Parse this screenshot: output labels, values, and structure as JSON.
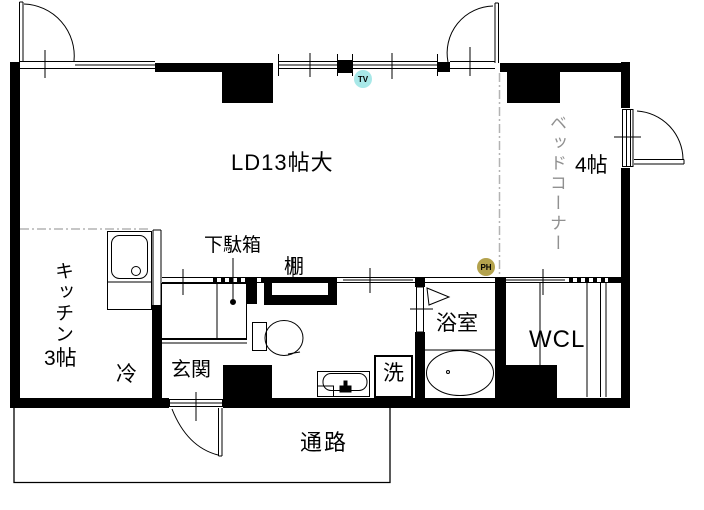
{
  "labels": {
    "living_dining": "LD13帖大",
    "bed_corner": "ベッドコーナー",
    "bed_corner_size": "4帖",
    "kitchen": "キッチン",
    "kitchen_size": "3帖",
    "refrigerator": "冷",
    "entrance": "玄関",
    "shoe_cabinet": "下駄箱",
    "shelf": "棚",
    "bathroom": "浴室",
    "washing_machine": "洗",
    "walk_in_closet": "WCL",
    "passage": "通路"
  },
  "markers": {
    "tv": {
      "label": "TV",
      "bg": "#a8e8e8"
    },
    "ph": {
      "label": "PH",
      "bg": "#b3a24d"
    }
  },
  "colors": {
    "wall": "#000000",
    "background": "#ffffff",
    "muted_label": "#909090",
    "zone_divider": "#b3b3b3"
  }
}
